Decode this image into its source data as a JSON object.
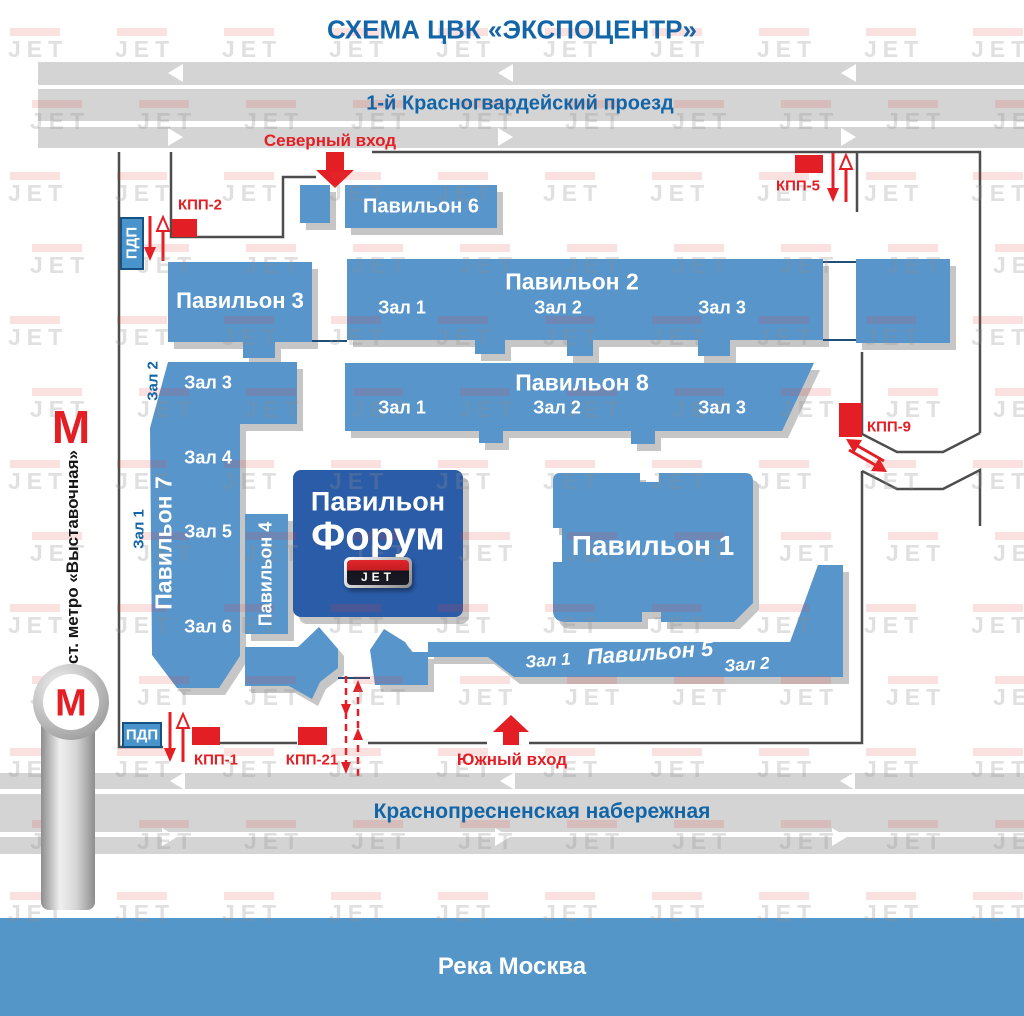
{
  "title": "СХЕМА ЦВК «ЭКСПОЦЕНТР»",
  "watermark": "JET",
  "colors": {
    "c-pav": "#5795cb",
    "c-forum": "#2b5ca8",
    "c-red": "#e31e24",
    "c-road": "#d4d4d4",
    "c-blue": "#1265a7",
    "c-river": "#5596c8",
    "c-fence": "#4d4d4d",
    "c-navy": "#1f4e79"
  },
  "roads": {
    "north": "1-й Красногвардейский проезд",
    "south": "Краснопресненская набережная",
    "river": "Река Москва"
  },
  "entrances": {
    "north": "Северный вход",
    "south": "Южный вход"
  },
  "checkpoints": {
    "kpp1": "КПП-1",
    "kpp2": "КПП-2",
    "kpp5": "КПП-5",
    "kpp9": "КПП-9",
    "kpp21": "КПП-21",
    "pdp_top": "ПДП",
    "pdp_bottom": "ПДП"
  },
  "metro": {
    "symbol": "М",
    "station": "ст. метро «Выставочная»"
  },
  "pavilions": {
    "p6": "Павильон 6",
    "p3": "Павильон 3",
    "p2": {
      "name": "Павильон 2",
      "halls": [
        "Зал 1",
        "Зал 2",
        "Зал 3"
      ]
    },
    "p8": {
      "name": "Павильон 8",
      "halls": [
        "Зал 1",
        "Зал 2",
        "Зал 3"
      ]
    },
    "p7": {
      "name": "Павильон 7",
      "halls_inside": [
        "Зал 3",
        "Зал 4",
        "Зал 5",
        "Зал 6"
      ],
      "halls_side": [
        "Зал 1",
        "Зал 2"
      ]
    },
    "p4": "Павильон 4",
    "forum": {
      "line1": "Павильон",
      "line2": "Форум",
      "logo": "JET"
    },
    "p1": "Павильон 1",
    "p5": {
      "name": "Павильон 5",
      "halls": [
        "Зал 1",
        "Зал 2"
      ]
    }
  }
}
